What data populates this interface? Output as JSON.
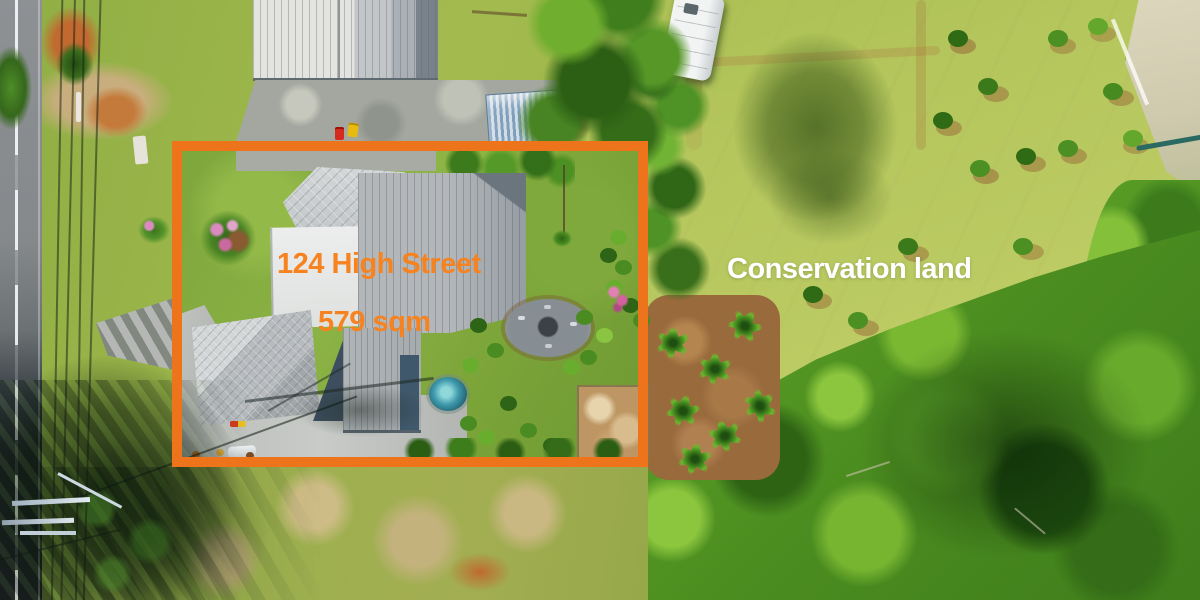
{
  "overlay": {
    "address_label": "124 High Street",
    "area_label": "579 sqm",
    "conservation_label": "Conservation land"
  },
  "colors": {
    "boundary_orange": "#EE741C",
    "label_orange": "#F6831F",
    "label_white": "#FFFFFF"
  }
}
